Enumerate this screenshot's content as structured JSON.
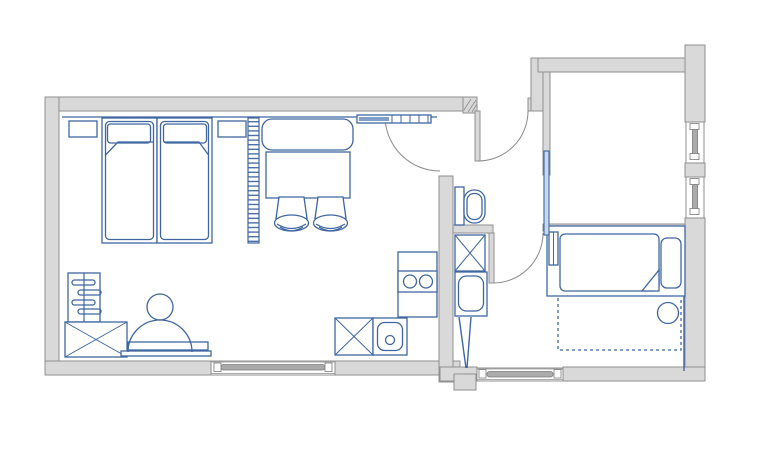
{
  "document": {
    "type": "architectural floor plan",
    "visible_text": ""
  },
  "colors": {
    "background": "#ffffff",
    "wall_fill": "#d9d9d9",
    "wall_stroke": "#8f8f8f",
    "furniture_stroke": "#3f66a0",
    "door_arc": "#8a8a8a",
    "sliding_door_fill": "#c7d9ec",
    "coat_rack_fill": "#7fa1c9",
    "window_sash": "#ababab"
  },
  "plan": {
    "rooms": [
      {
        "id": "main-room",
        "description": "large combined living / sleeping room with kitchenette",
        "furniture": [
          "twin-bed-1",
          "twin-bed-2",
          "nightstand-left",
          "nightstand-right",
          "hatched-shelf-divider",
          "sofa",
          "table",
          "chair-1",
          "chair-2",
          "coat-rack",
          "shoe-shelf",
          "wardrobe-x",
          "desk",
          "desk-chair",
          "kitchen-counter-stove",
          "appliance-x",
          "kitchen-sink"
        ],
        "windows": [
          "south-window"
        ],
        "doors": [
          "room-entry-door"
        ]
      },
      {
        "id": "hallway",
        "description": "entry hall with toilet alcove",
        "furniture": [
          "toilet"
        ],
        "doors": [
          "apartment-entry-door",
          "bathroom-door",
          "bedroom-sliding-door"
        ]
      },
      {
        "id": "bathroom",
        "description": "bathroom strip with shaft, sink and rack",
        "furniture": [
          "duct-shaft-x",
          "bathroom-sink",
          "drying-rack"
        ]
      },
      {
        "id": "bedroom",
        "description": "small bedroom",
        "furniture": [
          "single-bed",
          "side-table",
          "bed-extension-dashed"
        ],
        "windows": [
          "east-window-1",
          "east-window-2",
          "south-window-right"
        ]
      }
    ]
  }
}
